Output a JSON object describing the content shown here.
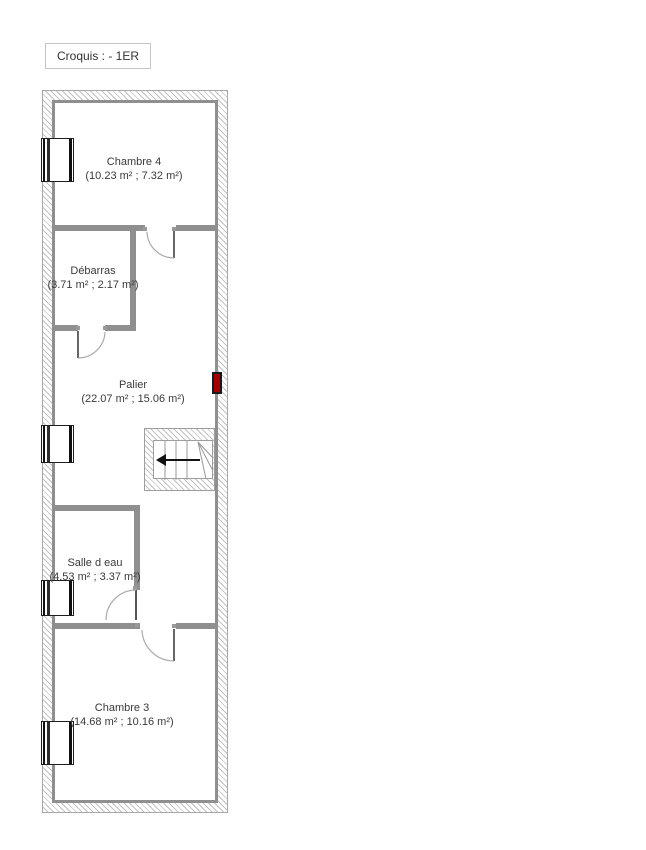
{
  "title_box": {
    "label": "Croquis : - 1ER"
  },
  "floor_plan": {
    "rooms": [
      {
        "name": "Chambre 4",
        "area": "(10.23 m² ; 7.32 m²)"
      },
      {
        "name": "Débarras",
        "area": "(3.71 m² ; 2.17 m²)"
      },
      {
        "name": "Palier",
        "area": "(22.07 m² ; 15.06 m²)"
      },
      {
        "name": "Salle d eau",
        "area": "(4.53 m² ; 3.37 m²)"
      },
      {
        "name": "Chambre 3",
        "area": "(14.68 m² ; 10.16 m²)"
      }
    ],
    "symbols": {
      "windows": [
        "chambre-4-window",
        "palier-window",
        "salle-d-eau-window",
        "chambre-3-window"
      ],
      "doors": [
        "chambre-4-door",
        "debarras-door",
        "salle-d-eau-door",
        "chambre-3-door"
      ],
      "stairs": "staircase-arrow-left",
      "radiator": "wall-radiator"
    },
    "colors": {
      "wall": "#8f8f8f",
      "hatch_line": "#c2c2c2",
      "door_arc": "#aaaaaa",
      "radiator": "#a40000",
      "stair_arrow": "#111111"
    }
  }
}
